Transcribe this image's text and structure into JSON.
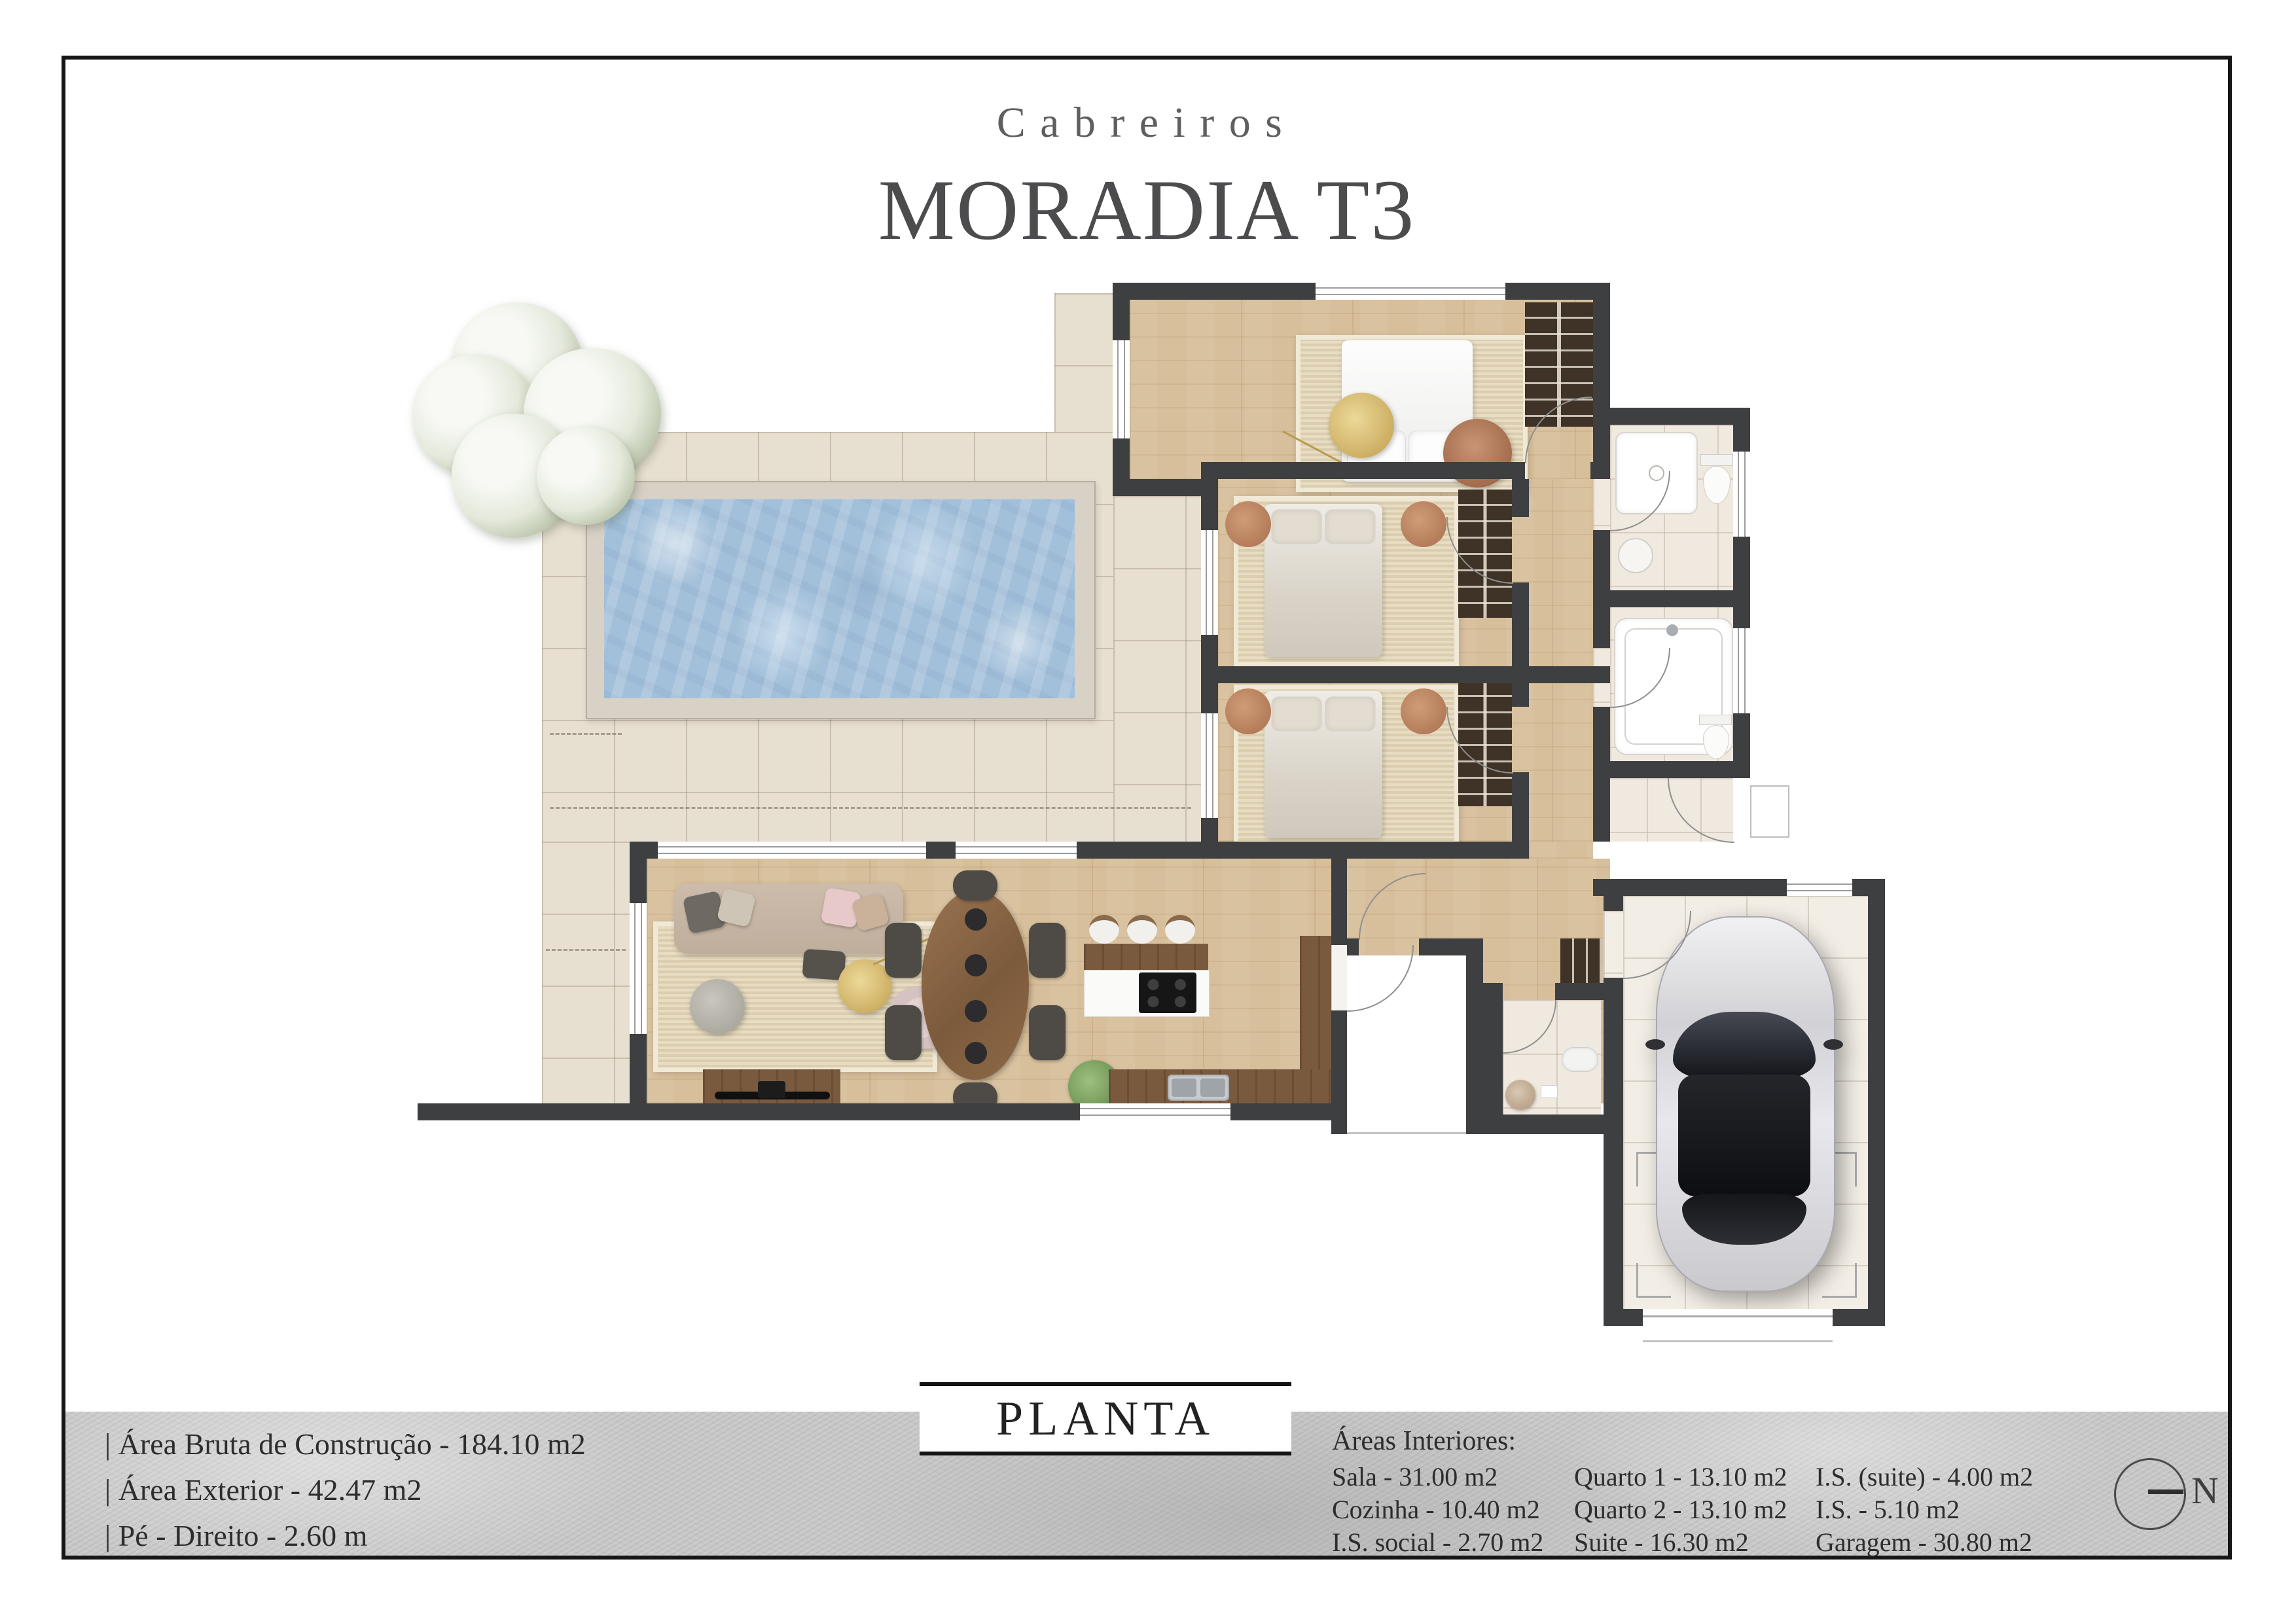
{
  "header": {
    "brand": "Cabreiros",
    "title": "MORADIA T3"
  },
  "plan_label": "PLANTA",
  "specs": {
    "items": [
      "|  Área Bruta de Construção - 184.10 m2",
      "|  Área Exterior - 42.47 m2",
      "|  Pé - Direito - 2.60 m"
    ]
  },
  "areas": {
    "heading": "Áreas Interiores:",
    "col1": [
      "Sala - 31.00 m2",
      "Cozinha - 10.40 m2",
      "I.S. social - 2.70 m2"
    ],
    "col2": [
      "Quarto 1 - 13.10 m2",
      "Quarto 2 - 13.10 m2",
      "Suite - 16.30 m2"
    ],
    "col3": [
      "I.S. (suite) - 4.00 m2",
      "I.S. - 5.10 m2",
      "Garagem - 30.80 m2"
    ]
  },
  "compass": {
    "label": "N"
  },
  "palette": {
    "wall": "#3e3f41",
    "wood_floor": "#d7bf9b",
    "dark_wood": "#7a5a3e",
    "terrace_tile": "#e7dfd0",
    "pool_water": "#a3c0da",
    "band_gray": "#c8c8c8",
    "title_gray": "#4c4c4e"
  }
}
